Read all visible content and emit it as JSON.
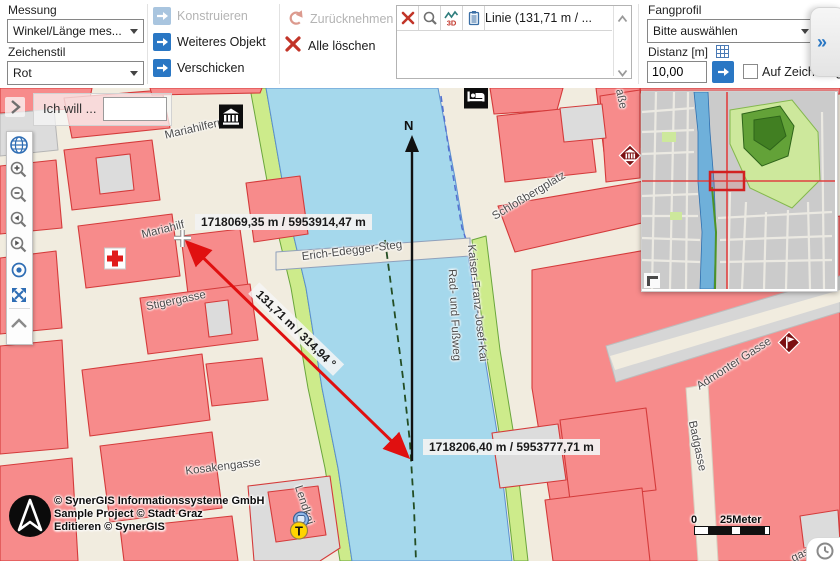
{
  "colors": {
    "accent_blue": "#2a77c4",
    "measure_red": "#e01010",
    "building_pink": "#f78b8b",
    "river_blue": "#a5d8ec",
    "bank_green": "#cdeb8b",
    "crosshair_red": "#e03030",
    "poi_diamond_red": "#7d1012"
  },
  "toolbar": {
    "messung": {
      "label": "Messung",
      "type_value": "Winkel/Länge mes...",
      "style_label": "Zeichenstil",
      "style_value": "Rot"
    },
    "buttons": {
      "konstruieren": "Konstruieren",
      "weiteres_objekt": "Weiteres Objekt",
      "verschicken": "Verschicken",
      "zuruecknehmen": "Zurücknehmen",
      "alle_loeschen": "Alle löschen"
    },
    "results": {
      "selected": "Linie (131,71 m / ...",
      "icons": [
        "delete-measurement-icon",
        "zoom-to-measurement-icon",
        "profile-3d-icon",
        "report-icon"
      ]
    },
    "fangprofil": {
      "label": "Fangprofil",
      "value": "Bitte auswählen",
      "distanz_label": "Distanz [m]",
      "distanz_value": "10,00",
      "snap_label": "Auf Zeichnung fang",
      "expander": "»"
    }
  },
  "map": {
    "search_label": "Ich will ...",
    "north": "N",
    "measurement": {
      "start": "1718069,35 m / 5953914,47 m",
      "end": "1718206,40 m / 5953777,71 m",
      "segment": "131,71 m / 314,94 °"
    },
    "street_labels": [
      {
        "name": "street-label-mariahilferplatz",
        "text": "Mariahilferplatz",
        "x": 203,
        "y": 39,
        "rot": -13
      },
      {
        "name": "street-label-mariahilf",
        "text": "Mariahilf",
        "x": 163,
        "y": 142,
        "rot": -14
      },
      {
        "name": "street-label-erich-edegger-steg",
        "text": "Erich-Edegger-Steg",
        "x": 352,
        "y": 163,
        "rot": -7
      },
      {
        "name": "street-label-kaiser-franz-josef-kai",
        "text": "Kaiser-Franz-Josef-Kai",
        "x": 477,
        "y": 215,
        "rot": 84
      },
      {
        "name": "street-label-rad-und-fussweg",
        "text": "Rad- und Fußweg",
        "x": 454,
        "y": 227,
        "rot": 87
      },
      {
        "name": "street-label-schlossbergplatz",
        "text": "Schloßbergplatz",
        "x": 529,
        "y": 108,
        "rot": -31
      },
      {
        "name": "street-label-stigergasse",
        "text": "Stigergasse",
        "x": 176,
        "y": 213,
        "rot": -12
      },
      {
        "name": "street-label-kosakengasse",
        "text": "Kosakengasse",
        "x": 223,
        "y": 379,
        "rot": -7
      },
      {
        "name": "street-label-lendkai",
        "text": "Lendkai",
        "x": 304,
        "y": 417,
        "rot": 72
      },
      {
        "name": "street-label-admonter-gasse",
        "text": "Admonter Gasse",
        "x": 734,
        "y": 276,
        "rot": -33
      },
      {
        "name": "street-label-badgasse",
        "text": "Badgasse",
        "x": 697,
        "y": 358,
        "rot": 78
      },
      {
        "name": "street-label-strasse-partial",
        "text": "aße",
        "x": 621,
        "y": 11,
        "rot": 78
      },
      {
        "name": "street-label-gasse-partial",
        "text": "gass",
        "x": 803,
        "y": 466,
        "rot": -25
      }
    ],
    "pois": [
      {
        "name": "museum-icon",
        "type": "museum-square",
        "x": 231,
        "y": 31
      },
      {
        "name": "hotel-icon",
        "type": "hotel-square",
        "x": 476,
        "y": 11
      },
      {
        "name": "museum-diamond-icon",
        "type": "museum-diamond",
        "x": 630,
        "y": 70
      },
      {
        "name": "flag-diamond-icon",
        "type": "flag-diamond",
        "x": 789,
        "y": 257
      },
      {
        "name": "pharmacy-cross-icon",
        "type": "red-cross",
        "x": 115,
        "y": 173
      },
      {
        "name": "taxi-icon",
        "type": "taxi",
        "x": 300,
        "y": 440
      }
    ],
    "copyright": {
      "line1": "© SynerGIS Informationssysteme GmbH",
      "line2": "Sample Project © Stadt Graz",
      "line3": "Editieren © SynerGIS"
    },
    "scalebar": {
      "start": "0",
      "end": "25Meter"
    }
  }
}
